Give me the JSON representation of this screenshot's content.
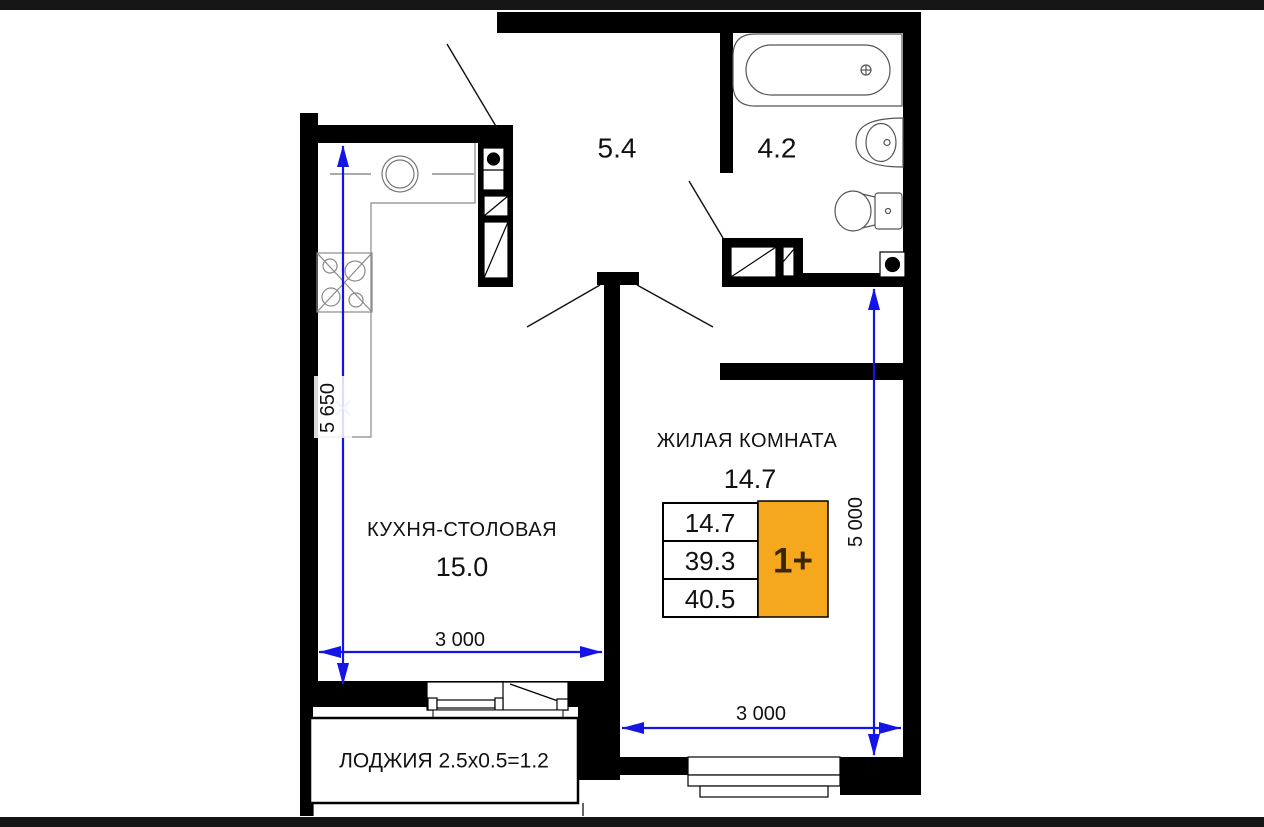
{
  "colors": {
    "wall": "#000000",
    "dimension_blue": "#1414e6",
    "accent_orange": "#f5a71d",
    "text": "#111111"
  },
  "rooms": {
    "hallway": {
      "area": "5.4"
    },
    "bathroom": {
      "area": "4.2"
    },
    "living": {
      "name": "ЖИЛАЯ КОМНАТА",
      "area": "14.7"
    },
    "kitchen": {
      "name": "КУХНЯ-СТОЛОВАЯ",
      "area": "15.0"
    },
    "loggia": {
      "label": "ЛОДЖИЯ 2.5x0.5=1.2"
    }
  },
  "dimensions": {
    "kitchen_height": "5 650",
    "kitchen_width": "3 000",
    "living_width": "3 000",
    "living_height": "5 000"
  },
  "spec_table": {
    "rows": [
      "14.7",
      "39.3",
      "40.5"
    ],
    "type_label": "1+"
  }
}
